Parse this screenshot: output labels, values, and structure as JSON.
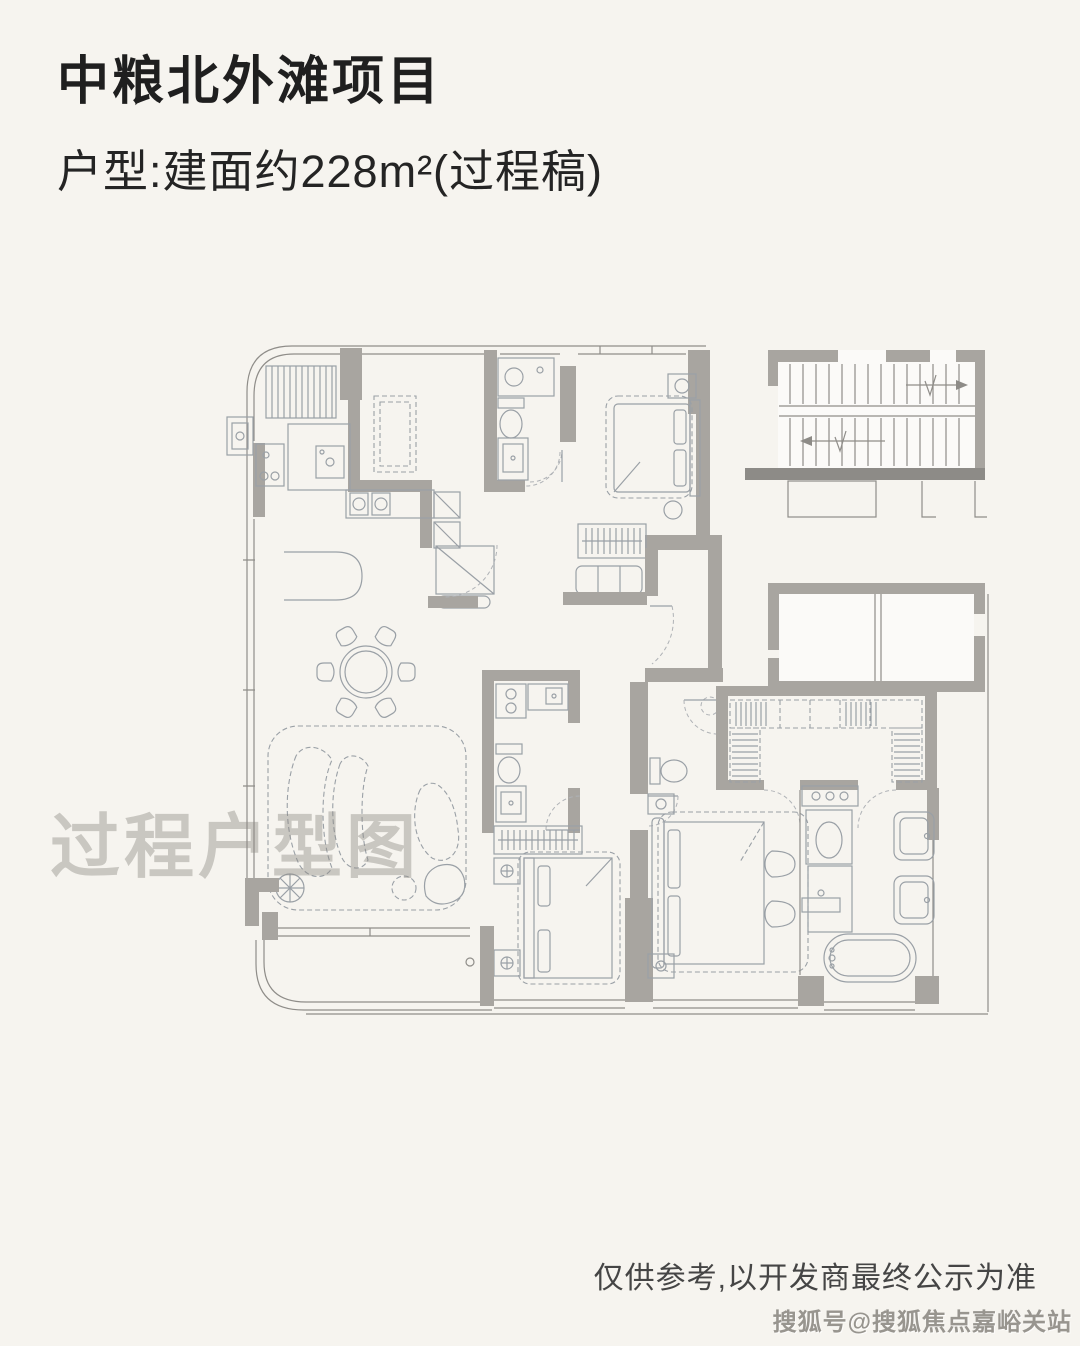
{
  "page": {
    "background_color": "#f6f4ef"
  },
  "header": {
    "title": "中粮北外滩项目",
    "subtitle": "户型:建面约228m²(过程稿)"
  },
  "floorplan": {
    "watermark": "过程户型图",
    "colors": {
      "wall": "#a8a5a0",
      "wall_dark": "#8d8b87",
      "thin_line": "#8f8d89",
      "furniture_line": "#9aa0a6",
      "room_white": "#fbfaf8"
    }
  },
  "footer": {
    "disclaimer": "仅供参考,以开发商最终公示为准",
    "source_tag": "搜狐号@搜狐焦点嘉峪关站"
  }
}
